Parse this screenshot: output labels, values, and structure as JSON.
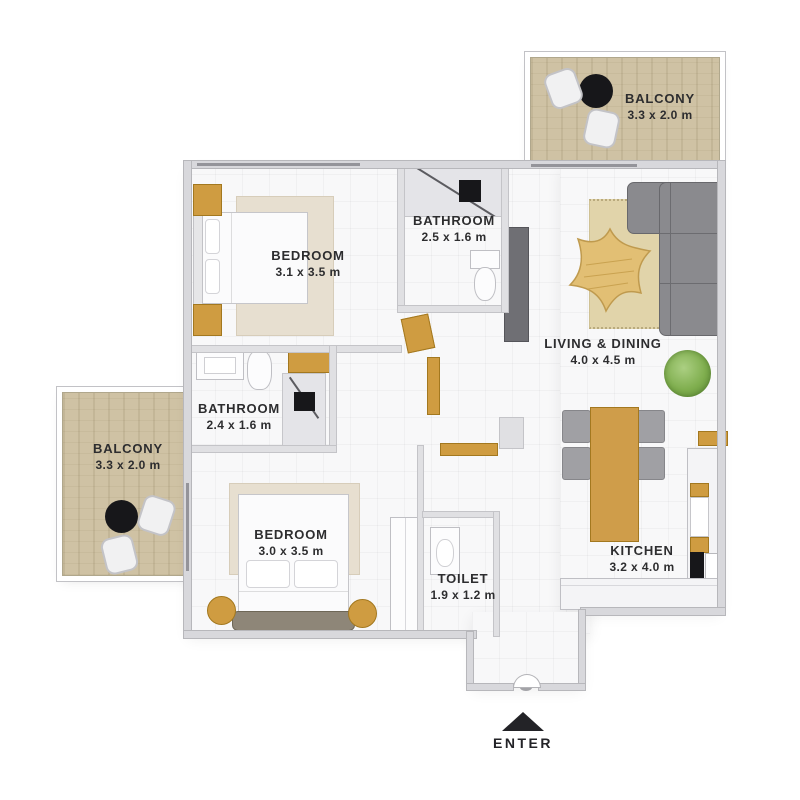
{
  "plan": {
    "rooms": [
      {
        "id": "balcony-top-right",
        "name": "BALCONY",
        "dims": "3.3 x 2.0 m"
      },
      {
        "id": "bedroom-top",
        "name": "BEDROOM",
        "dims": "3.1 x 3.5 m"
      },
      {
        "id": "bathroom-top",
        "name": "BATHROOM",
        "dims": "2.5 x 1.6 m"
      },
      {
        "id": "living-dining",
        "name": "LIVING & DINING",
        "dims": "4.0 x 4.5 m"
      },
      {
        "id": "bathroom-middle",
        "name": "BATHROOM",
        "dims": "2.4 x 1.6 m"
      },
      {
        "id": "balcony-left",
        "name": "BALCONY",
        "dims": "3.3 x 2.0 m"
      },
      {
        "id": "bedroom-bottom",
        "name": "BEDROOM",
        "dims": "3.0 x 3.5 m"
      },
      {
        "id": "toilet",
        "name": "TOILET",
        "dims": "1.9 x 1.2 m"
      },
      {
        "id": "kitchen",
        "name": "KITCHEN",
        "dims": "3.2 x 4.0 m"
      }
    ],
    "entry": {
      "label": "ENTER"
    },
    "colors": {
      "label_text": "#2d2d2f",
      "wood_balcony_floor": "#cfc2a4",
      "accent_wood": "#cf9c41",
      "sofa_gray": "#8a8a8e",
      "living_rug": "#e1d4aa",
      "bedroom_rug": "#e7dfd0",
      "plant_green": "#7fae4e",
      "wall_gray": "#d8d8dc",
      "floor_white": "#f8f8f9",
      "entry_arrow": "#232327"
    }
  }
}
